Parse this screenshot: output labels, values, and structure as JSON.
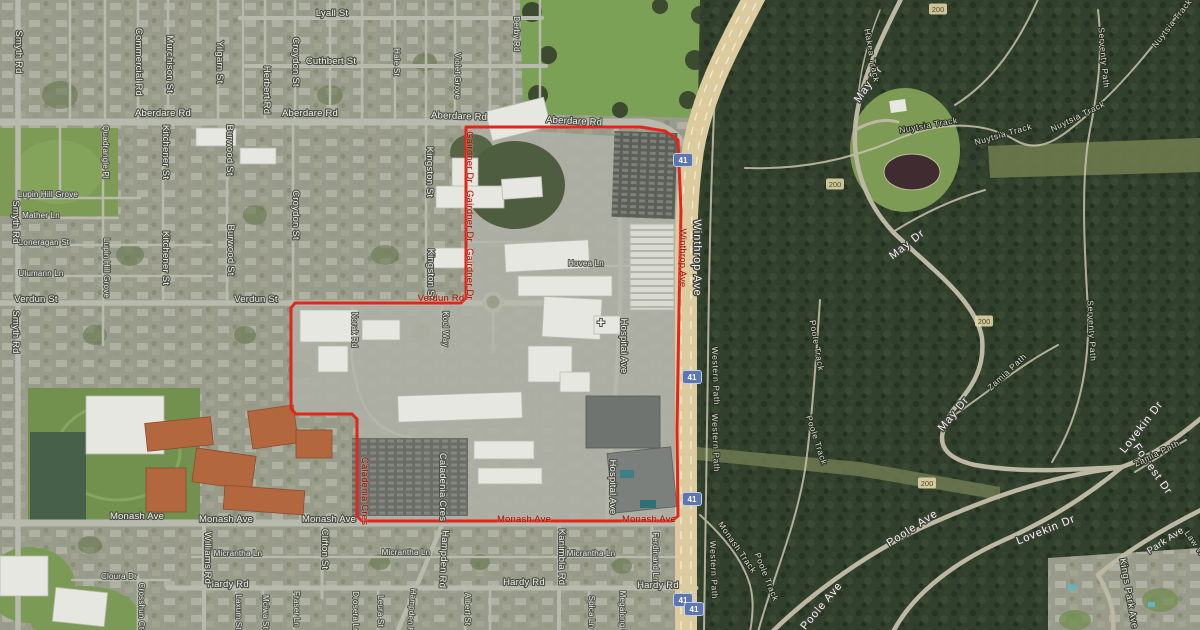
{
  "map": {
    "kind": "satellite-map",
    "accent_colors": {
      "boundary_red": "#e2261b",
      "route_shield_blue": "#5b76b0",
      "contour_tan": "#e1d6aa"
    },
    "boundary": {
      "color": "#e2261b",
      "points": [
        [
          466,
          127
        ],
        [
          640,
          127
        ],
        [
          665,
          131
        ],
        [
          678,
          140
        ],
        [
          681,
          210
        ],
        [
          679,
          310
        ],
        [
          677,
          430
        ],
        [
          678,
          516
        ],
        [
          672,
          521
        ],
        [
          362,
          521
        ],
        [
          357,
          516
        ],
        [
          357,
          419
        ],
        [
          352,
          414
        ],
        [
          296,
          414
        ],
        [
          291,
          409
        ],
        [
          291,
          308
        ],
        [
          295,
          303
        ],
        [
          461,
          303
        ],
        [
          466,
          298
        ]
      ]
    },
    "helipad": {
      "glyph": "+",
      "x": 601,
      "y": 327
    },
    "route_shields": [
      {
        "t": "41",
        "x": 683,
        "y": 160
      },
      {
        "t": "41",
        "x": 692,
        "y": 377
      },
      {
        "t": "41",
        "x": 692,
        "y": 499
      },
      {
        "t": "41",
        "x": 683,
        "y": 600
      },
      {
        "t": "41",
        "x": 694,
        "y": 609
      }
    ],
    "contour_markers": [
      {
        "t": "200",
        "x": 938,
        "y": 9
      },
      {
        "t": "200",
        "x": 835,
        "y": 184
      },
      {
        "t": "200",
        "x": 984,
        "y": 321
      },
      {
        "t": "200",
        "x": 927,
        "y": 483
      }
    ],
    "labels": [
      {
        "t": "Lyall St",
        "x": 332,
        "y": 16,
        "r": 0,
        "c": "st"
      },
      {
        "t": "Cuthbert St",
        "x": 331,
        "y": 64,
        "r": 0,
        "c": "st"
      },
      {
        "t": "Aberdare Rd",
        "x": 163,
        "y": 116,
        "r": 0,
        "c": "st"
      },
      {
        "t": "Aberdare Rd",
        "x": 310,
        "y": 116,
        "r": 0,
        "c": "st"
      },
      {
        "t": "Aberdare Rd",
        "x": 459,
        "y": 119,
        "r": 2,
        "c": "st"
      },
      {
        "t": "Aberdare Rd",
        "x": 574,
        "y": 124,
        "r": 3,
        "c": "st"
      },
      {
        "t": "Verdun St",
        "x": 36,
        "y": 302,
        "r": 0,
        "c": "st"
      },
      {
        "t": "Verdun St",
        "x": 256,
        "y": 302,
        "r": 0,
        "c": "st"
      },
      {
        "t": "Monash Ave",
        "x": 137,
        "y": 519,
        "r": 0,
        "c": "st"
      },
      {
        "t": "Monash Ave",
        "x": 226,
        "y": 522,
        "r": 0,
        "c": "st"
      },
      {
        "t": "Monash Ave",
        "x": 329,
        "y": 522,
        "r": 0,
        "c": "st"
      },
      {
        "t": "Hardy Rd",
        "x": 228,
        "y": 587,
        "r": 0,
        "c": "st"
      },
      {
        "t": "Hardy Rd",
        "x": 524,
        "y": 585,
        "r": 0,
        "c": "st"
      },
      {
        "t": "Hardy Rd",
        "x": 658,
        "y": 588,
        "r": 0,
        "c": "st"
      },
      {
        "t": "Lupin Hill Grove",
        "x": 48,
        "y": 197,
        "r": 0,
        "c": "ln"
      },
      {
        "t": "Mather Ln",
        "x": 41,
        "y": 218,
        "r": 0,
        "c": "ln"
      },
      {
        "t": "Loneragan St",
        "x": 44,
        "y": 245,
        "r": 0,
        "c": "ln"
      },
      {
        "t": "Ulumann Ln",
        "x": 41,
        "y": 276,
        "r": 0,
        "c": "ln"
      },
      {
        "t": "Cloura Dr",
        "x": 119,
        "y": 579,
        "r": 0,
        "c": "ln"
      },
      {
        "t": "Micrantha Ln",
        "x": 238,
        "y": 556,
        "r": 0,
        "c": "ln"
      },
      {
        "t": "Micrantha Ln",
        "x": 406,
        "y": 555,
        "r": 0,
        "c": "ln"
      },
      {
        "t": "Micrantha Ln",
        "x": 591,
        "y": 556,
        "r": 0,
        "c": "ln"
      },
      {
        "t": "Hovea Ln",
        "x": 586,
        "y": 266,
        "r": 0,
        "c": "ln"
      },
      {
        "t": "Smyth Rd",
        "x": 16,
        "y": 52,
        "r": 90,
        "c": "st"
      },
      {
        "t": "Smyth Rd",
        "x": 13,
        "y": 222,
        "r": 90,
        "c": "st"
      },
      {
        "t": "Smyth Rd",
        "x": 13,
        "y": 332,
        "r": 90,
        "c": "st"
      },
      {
        "t": "Commercial Rd",
        "x": 136,
        "y": 62,
        "r": 90,
        "c": "st"
      },
      {
        "t": "Murchison St",
        "x": 167,
        "y": 64,
        "r": 90,
        "c": "st"
      },
      {
        "t": "Yilgarn St",
        "x": 217,
        "y": 62,
        "r": 90,
        "c": "st"
      },
      {
        "t": "Herbert Rd",
        "x": 264,
        "y": 90,
        "r": 90,
        "c": "st"
      },
      {
        "t": "Croydon St",
        "x": 293,
        "y": 62,
        "r": 90,
        "c": "st"
      },
      {
        "t": "Croydon St",
        "x": 293,
        "y": 215,
        "r": 90,
        "c": "st"
      },
      {
        "t": "Hale St",
        "x": 394,
        "y": 62,
        "r": 90,
        "c": "ln"
      },
      {
        "t": "Violet Grove",
        "x": 455,
        "y": 76,
        "r": 90,
        "c": "ln"
      },
      {
        "t": "Derby Rd",
        "x": 514,
        "y": 34,
        "r": 90,
        "c": "ln"
      },
      {
        "t": "Quadrangle Pl",
        "x": 103,
        "y": 152,
        "r": 90,
        "c": "ln"
      },
      {
        "t": "Lupin Hill Grove",
        "x": 104,
        "y": 268,
        "r": 90,
        "c": "ln"
      },
      {
        "t": "Kitchener St",
        "x": 163,
        "y": 152,
        "r": 90,
        "c": "st"
      },
      {
        "t": "Kitchener St",
        "x": 163,
        "y": 258,
        "r": 90,
        "c": "st"
      },
      {
        "t": "Burwood St",
        "x": 227,
        "y": 150,
        "r": 90,
        "c": "st"
      },
      {
        "t": "Burwood St",
        "x": 228,
        "y": 250,
        "r": 90,
        "c": "st"
      },
      {
        "t": "Kingston St",
        "x": 427,
        "y": 172,
        "r": 90,
        "c": "st"
      },
      {
        "t": "Kingston St",
        "x": 428,
        "y": 274,
        "r": 90,
        "c": "st"
      },
      {
        "t": "Norak Rd",
        "x": 352,
        "y": 330,
        "r": 90,
        "c": "ln"
      },
      {
        "t": "Kool Way",
        "x": 443,
        "y": 329,
        "r": 90,
        "c": "ln"
      },
      {
        "t": "Caladenia Cres",
        "x": 440,
        "y": 487,
        "r": 90,
        "c": "st"
      },
      {
        "t": "Hospital Ave",
        "x": 621,
        "y": 346,
        "r": 90,
        "c": "st"
      },
      {
        "t": "Hospital Ave",
        "x": 610,
        "y": 487,
        "r": 90,
        "c": "st"
      },
      {
        "t": "Winthrop Ave",
        "x": 694,
        "y": 258,
        "r": 90,
        "c": "mj"
      },
      {
        "t": "Williams Rd",
        "x": 205,
        "y": 558,
        "r": 90,
        "c": "st"
      },
      {
        "t": "Crosshun Ct",
        "x": 139,
        "y": 606,
        "r": 90,
        "c": "ln"
      },
      {
        "t": "Laxum St",
        "x": 236,
        "y": 612,
        "r": 90,
        "c": "ln"
      },
      {
        "t": "Mciwa St",
        "x": 263,
        "y": 612,
        "r": 90,
        "c": "ln"
      },
      {
        "t": "Fraser Ln",
        "x": 294,
        "y": 609,
        "r": 90,
        "c": "ln"
      },
      {
        "t": "Clifton St",
        "x": 322,
        "y": 549,
        "r": 90,
        "c": "st"
      },
      {
        "t": "Drosera Ln",
        "x": 353,
        "y": 612,
        "r": 90,
        "c": "ln"
      },
      {
        "t": "Leura St",
        "x": 378,
        "y": 611,
        "r": 90,
        "c": "ln"
      },
      {
        "t": "Hampden Rd",
        "x": 441,
        "y": 559,
        "r": 93,
        "c": "st"
      },
      {
        "t": "Hampden Rd",
        "x": 409,
        "y": 613,
        "r": 95,
        "c": "ln"
      },
      {
        "t": "Albert St",
        "x": 465,
        "y": 609,
        "r": 90,
        "c": "ln"
      },
      {
        "t": "Kanimbla Rd",
        "x": 559,
        "y": 557,
        "r": 90,
        "c": "st"
      },
      {
        "t": "Spica Ln",
        "x": 589,
        "y": 612,
        "r": 90,
        "c": "ln"
      },
      {
        "t": "Megalong Pl",
        "x": 620,
        "y": 614,
        "r": 90,
        "c": "ln"
      },
      {
        "t": "Ferdinand Ln",
        "x": 653,
        "y": 557,
        "r": 90,
        "c": "ln"
      },
      {
        "t": "Gairdner Dr",
        "x": 467,
        "y": 157,
        "r": 90,
        "c": "rd"
      },
      {
        "t": "Gairdner Dr",
        "x": 467,
        "y": 216,
        "r": 90,
        "c": "rd"
      },
      {
        "t": "Gairdner Dr",
        "x": 467,
        "y": 274,
        "r": 90,
        "c": "rd"
      },
      {
        "t": "Verdun Rd",
        "x": 441,
        "y": 301,
        "r": 0,
        "c": "rd"
      },
      {
        "t": "Winthrop Ave",
        "x": 680,
        "y": 258,
        "r": 90,
        "c": "rd"
      },
      {
        "t": "Caladenia Cres",
        "x": 362,
        "y": 491,
        "r": 90,
        "c": "rd"
      },
      {
        "t": "Monash Ave",
        "x": 524,
        "y": 522,
        "r": 0,
        "c": "rd"
      },
      {
        "t": "Monash Ave",
        "x": 649,
        "y": 522,
        "r": 0,
        "c": "rd"
      },
      {
        "t": "May Dr",
        "x": 871,
        "y": 86,
        "r": -56,
        "c": "mj"
      },
      {
        "t": "May Dr",
        "x": 909,
        "y": 247,
        "r": -38,
        "c": "mj"
      },
      {
        "t": "May Dr",
        "x": 956,
        "y": 416,
        "r": -50,
        "c": "mj"
      },
      {
        "t": "Lovekin Dr",
        "x": 1144,
        "y": 429,
        "r": -52,
        "c": "mj"
      },
      {
        "t": "Lovekin Dr",
        "x": 1047,
        "y": 533,
        "r": -22,
        "c": "mj"
      },
      {
        "t": "Forrest Dr",
        "x": 1150,
        "y": 471,
        "r": 55,
        "c": "mj"
      },
      {
        "t": "Poole Ave",
        "x": 914,
        "y": 531,
        "r": -33,
        "c": "mj"
      },
      {
        "t": "Poole Ave",
        "x": 824,
        "y": 608,
        "r": -50,
        "c": "mj"
      },
      {
        "t": "Park Ave",
        "x": 1167,
        "y": 543,
        "r": -33,
        "c": "pr"
      },
      {
        "t": "Kings Park Ave",
        "x": 1126,
        "y": 594,
        "r": 80,
        "c": "pr"
      },
      {
        "t": "Law Walk",
        "x": 1196,
        "y": 550,
        "r": 55,
        "c": "pk"
      },
      {
        "t": "Hakea Track",
        "x": 869,
        "y": 56,
        "r": 80,
        "c": "pk"
      },
      {
        "t": "Nuytsia Track",
        "x": 929,
        "y": 128,
        "r": -10,
        "c": "pk"
      },
      {
        "t": "Nuytsia Track",
        "x": 1004,
        "y": 137,
        "r": -16,
        "c": "pk"
      },
      {
        "t": "Nuytsia Track",
        "x": 1079,
        "y": 119,
        "r": -26,
        "c": "pk"
      },
      {
        "t": "Nuytsia Track",
        "x": 1174,
        "y": 25,
        "r": -52,
        "c": "pk"
      },
      {
        "t": "Serventy Path",
        "x": 1101,
        "y": 58,
        "r": 85,
        "c": "pk"
      },
      {
        "t": "Serventy Path",
        "x": 1089,
        "y": 331,
        "r": 87,
        "c": "pk"
      },
      {
        "t": "Zamia Path",
        "x": 1009,
        "y": 374,
        "r": -43,
        "c": "pk"
      },
      {
        "t": "Zamia Path",
        "x": 1158,
        "y": 456,
        "r": -26,
        "c": "pk"
      },
      {
        "t": "Western Path",
        "x": 713,
        "y": 376,
        "r": 88,
        "c": "pk"
      },
      {
        "t": "Western Path",
        "x": 713,
        "y": 443,
        "r": 88,
        "c": "pk"
      },
      {
        "t": "Western Path",
        "x": 711,
        "y": 570,
        "r": 88,
        "c": "pk"
      },
      {
        "t": "Poole Track",
        "x": 814,
        "y": 346,
        "r": 80,
        "c": "pk"
      },
      {
        "t": "Poole Track",
        "x": 814,
        "y": 441,
        "r": 72,
        "c": "pk"
      },
      {
        "t": "Poole Track",
        "x": 764,
        "y": 578,
        "r": 68,
        "c": "pk"
      },
      {
        "t": "Monash Track",
        "x": 735,
        "y": 549,
        "r": 55,
        "c": "pk"
      }
    ]
  }
}
